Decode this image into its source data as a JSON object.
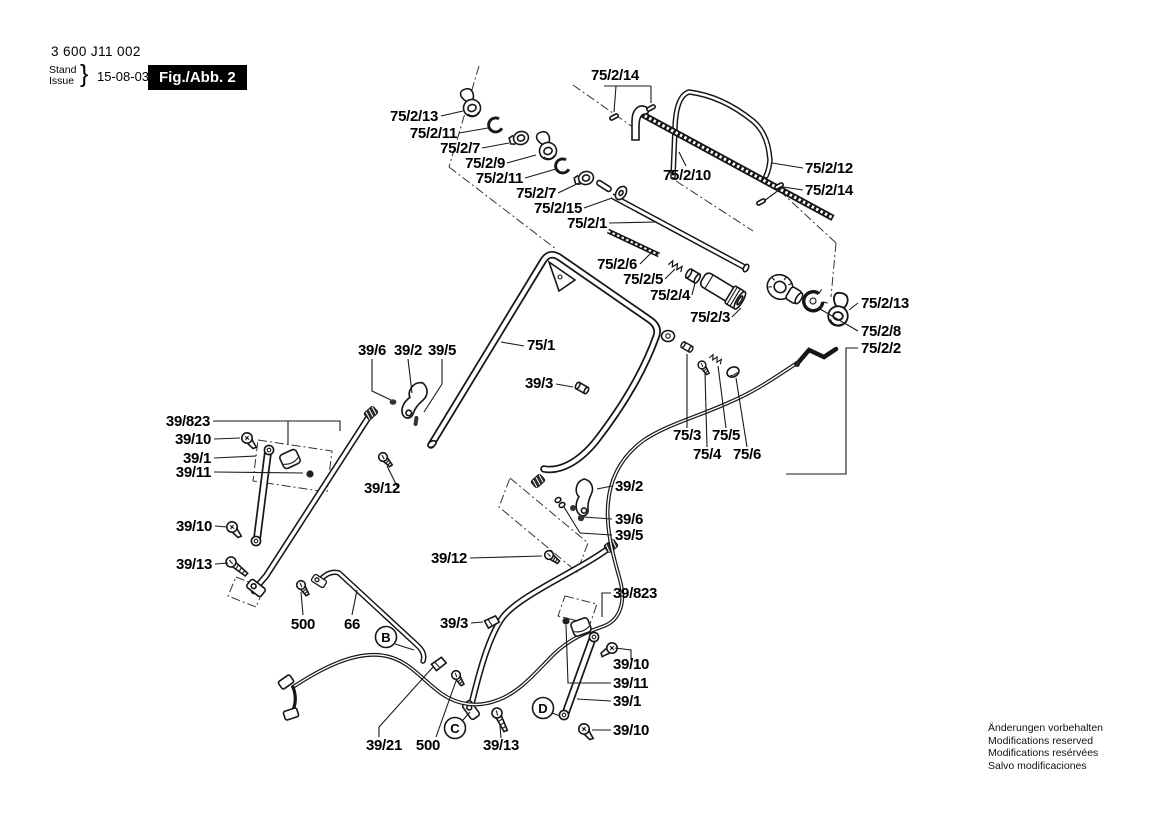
{
  "header": {
    "part_number": "3 600 J11 002",
    "stand": "Stand",
    "issue": "Issue",
    "brace": "}",
    "date": "15-08-03",
    "figure": "Fig./Abb. 2"
  },
  "footer": {
    "lines": [
      "Änderungen vorbehalten",
      "Modifications reserved",
      "Modifications resérvées",
      "Salvo modificaciones"
    ]
  },
  "balloons": [
    "B",
    "C",
    "D"
  ],
  "labels": [
    "75/2/14",
    "75/2/13",
    "75/2/11",
    "75/2/7",
    "75/2/9",
    "75/2/11",
    "75/2/7",
    "75/2/15",
    "75/2/1",
    "75/2/10",
    "75/2/12",
    "75/2/14",
    "75/2/13",
    "75/2/8",
    "75/2/2",
    "75/2/6",
    "75/2/5",
    "75/2/4",
    "75/2/3",
    "75/1",
    "39/6",
    "39/2",
    "39/5",
    "39/3",
    "39/823",
    "39/10",
    "39/1",
    "39/11",
    "39/12",
    "39/10",
    "39/13",
    "39/2",
    "39/6",
    "39/5",
    "39/12",
    "75/3",
    "75/5",
    "75/4",
    "75/6",
    "500",
    "66",
    "39/3",
    "39/823",
    "39/10",
    "39/11",
    "39/1",
    "39/10",
    "39/21",
    "500",
    "39/13"
  ],
  "colors": {
    "line": "#1a1a1a",
    "figure_box_bg": "#000000",
    "figure_box_text": "#ffffff"
  }
}
